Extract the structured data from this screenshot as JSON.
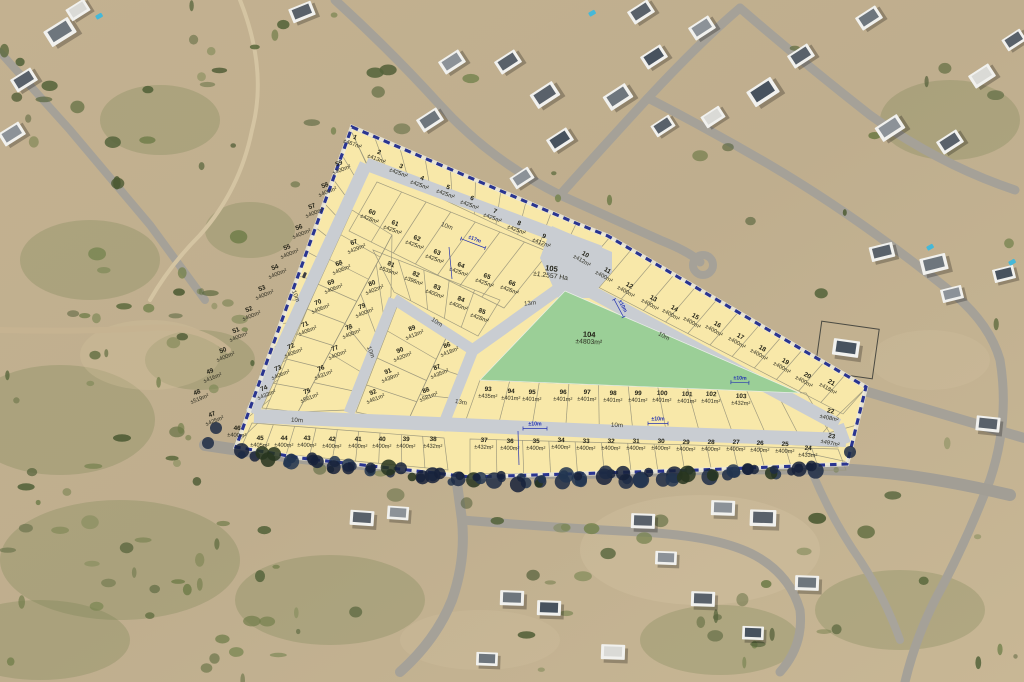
{
  "site_plan": {
    "colors": {
      "plot_fill": "#f8e8a9",
      "road_fill": "#c9cdd2",
      "open_space_fill": "#9bcf97",
      "boundary": "#2a3590",
      "parcel_line": "#97937a",
      "dimension_blue": "#2433b0"
    },
    "plots": [
      {
        "id": "1",
        "area": "±467m²"
      },
      {
        "id": "2",
        "area": "±413m²"
      },
      {
        "id": "3",
        "area": "±425m²"
      },
      {
        "id": "4",
        "area": "±425m²"
      },
      {
        "id": "5",
        "area": "±425m²"
      },
      {
        "id": "6",
        "area": "±425m²"
      },
      {
        "id": "7",
        "area": "±425m²"
      },
      {
        "id": "8",
        "area": "±425m²"
      },
      {
        "id": "9",
        "area": "±412m²"
      },
      {
        "id": "10",
        "area": "±412m²"
      },
      {
        "id": "11",
        "area": "±400m²"
      },
      {
        "id": "12",
        "area": "±400m²"
      },
      {
        "id": "13",
        "area": "±400m²"
      },
      {
        "id": "14",
        "area": "±400m²"
      },
      {
        "id": "15",
        "area": "±400m²"
      },
      {
        "id": "16",
        "area": "±400m²"
      },
      {
        "id": "17",
        "area": "±400m²"
      },
      {
        "id": "18",
        "area": "±400m²"
      },
      {
        "id": "19",
        "area": "±400m²"
      },
      {
        "id": "20",
        "area": "±400m²"
      },
      {
        "id": "21",
        "area": "±418m²"
      },
      {
        "id": "22",
        "area": "±408m²"
      },
      {
        "id": "23",
        "area": "±497m²"
      },
      {
        "id": "24",
        "area": "±433m²"
      },
      {
        "id": "25",
        "area": "±400m²"
      },
      {
        "id": "26",
        "area": "±400m²"
      },
      {
        "id": "27",
        "area": "±400m²"
      },
      {
        "id": "28",
        "area": "±400m²"
      },
      {
        "id": "29",
        "area": "±400m²"
      },
      {
        "id": "30",
        "area": "±400m²"
      },
      {
        "id": "31",
        "area": "±400m²"
      },
      {
        "id": "32",
        "area": "±400m²"
      },
      {
        "id": "33",
        "area": "±400m²"
      },
      {
        "id": "34",
        "area": "±400m²"
      },
      {
        "id": "35",
        "area": "±400m²"
      },
      {
        "id": "36",
        "area": "±400m²"
      },
      {
        "id": "37",
        "area": "±432m²"
      },
      {
        "id": "38",
        "area": "±432m²"
      },
      {
        "id": "39",
        "area": "±400m²"
      },
      {
        "id": "40",
        "area": "±400m²"
      },
      {
        "id": "41",
        "area": "±400m²"
      },
      {
        "id": "42",
        "area": "±400m²"
      },
      {
        "id": "43",
        "area": "±400m²"
      },
      {
        "id": "44",
        "area": "±400m²"
      },
      {
        "id": "45",
        "area": "±405m²"
      },
      {
        "id": "46",
        "area": "±400m²"
      },
      {
        "id": "47",
        "area": "±425m²"
      },
      {
        "id": "48",
        "area": "±519m²"
      },
      {
        "id": "49",
        "area": "±416m²"
      },
      {
        "id": "50",
        "area": "±400m²"
      },
      {
        "id": "51",
        "area": "±400m²"
      },
      {
        "id": "52",
        "area": "±400m²"
      },
      {
        "id": "53",
        "area": "±400m²"
      },
      {
        "id": "54",
        "area": "±400m²"
      },
      {
        "id": "55",
        "area": "±400m²"
      },
      {
        "id": "56",
        "area": "±400m²"
      },
      {
        "id": "57",
        "area": "±400m²"
      },
      {
        "id": "58",
        "area": "±400m²"
      },
      {
        "id": "59",
        "area": "±400m²"
      },
      {
        "id": "60",
        "area": "±428m²"
      },
      {
        "id": "61",
        "area": "±425m²"
      },
      {
        "id": "62",
        "area": "±425m²"
      },
      {
        "id": "63",
        "area": "±425m²"
      },
      {
        "id": "64",
        "area": "±425m²"
      },
      {
        "id": "65",
        "area": "±425m²"
      },
      {
        "id": "66",
        "area": "±426m²"
      },
      {
        "id": "67",
        "area": "±429m²"
      },
      {
        "id": "68",
        "area": "±406m²"
      },
      {
        "id": "69",
        "area": "±406m²"
      },
      {
        "id": "70",
        "area": "±406m²"
      },
      {
        "id": "71",
        "area": "±406m²"
      },
      {
        "id": "72",
        "area": "±406m²"
      },
      {
        "id": "73",
        "area": "±406m²"
      },
      {
        "id": "74",
        "area": "±433m²"
      },
      {
        "id": "75",
        "area": "±561m²"
      },
      {
        "id": "76",
        "area": "±431m²"
      },
      {
        "id": "77",
        "area": "±400m²"
      },
      {
        "id": "78",
        "area": "±400m²"
      },
      {
        "id": "79",
        "area": "±400m²"
      },
      {
        "id": "80",
        "area": "±402m²"
      },
      {
        "id": "81",
        "area": "±539m²"
      },
      {
        "id": "82",
        "area": "±396m²"
      },
      {
        "id": "83",
        "area": "±400m²"
      },
      {
        "id": "84",
        "area": "±400m²"
      },
      {
        "id": "85",
        "area": "±428m²"
      },
      {
        "id": "86",
        "area": "±418m²"
      },
      {
        "id": "87",
        "area": "±435m²"
      },
      {
        "id": "88",
        "area": "±581m²"
      },
      {
        "id": "89",
        "area": "±413m²"
      },
      {
        "id": "90",
        "area": "±420m²"
      },
      {
        "id": "91",
        "area": "±439m²"
      },
      {
        "id": "92",
        "area": "±461m²"
      },
      {
        "id": "93",
        "area": "±435m²"
      },
      {
        "id": "94",
        "area": "±401m²"
      },
      {
        "id": "95",
        "area": "±401m²"
      },
      {
        "id": "96",
        "area": "±401m²"
      },
      {
        "id": "97",
        "area": "±401m²"
      },
      {
        "id": "98",
        "area": "±401m²"
      },
      {
        "id": "99",
        "area": "±401m²"
      },
      {
        "id": "100",
        "area": "±401m²"
      },
      {
        "id": "101",
        "area": "±401m²"
      },
      {
        "id": "102",
        "area": "±401m²"
      },
      {
        "id": "103",
        "area": "±432m²"
      }
    ],
    "open_space": {
      "id": "104",
      "area": "±4803m²"
    },
    "road_reserve": {
      "id": "105",
      "area": "±1.2557 Ha"
    },
    "road_width_labels": [
      {
        "text": "10m"
      },
      {
        "text": "10m"
      },
      {
        "text": "13m"
      },
      {
        "text": "10m"
      },
      {
        "text": "10m"
      },
      {
        "text": "13m"
      },
      {
        "text": "10m"
      },
      {
        "text": "10m"
      },
      {
        "text": "10m"
      }
    ],
    "dimension_labels": [
      {
        "text": "±17m"
      },
      {
        "text": "±10m"
      },
      {
        "text": "±10m"
      },
      {
        "text": "±10m"
      },
      {
        "text": "±10m"
      }
    ]
  }
}
